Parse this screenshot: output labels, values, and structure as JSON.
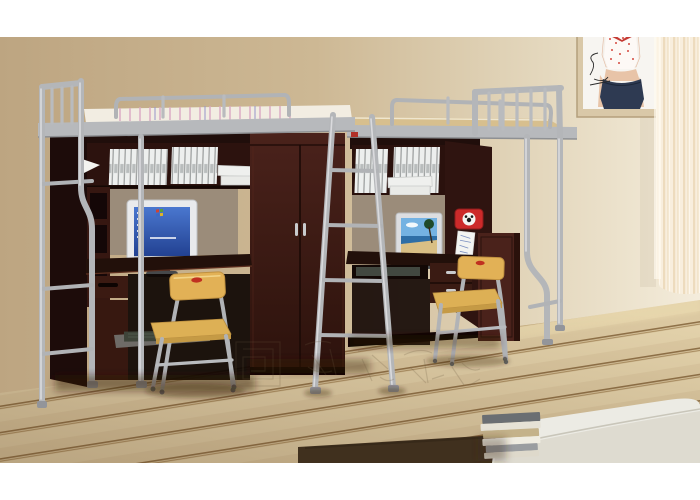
{
  "image": {
    "kind": "furniture product photograph",
    "subject": "two metal loft beds over computer desk and wardrobe units in a dormitory room",
    "visible_text": "none (only an illegible outlined watermark on the floor)"
  },
  "scene": {
    "room": {
      "wall": "beige painted wall, lighter toward the right",
      "floor": "light diagonal wood plank flooring",
      "window": "sheer cream curtain at right edge",
      "poster": "fashion poster of a woman in polka-dot top and jeans on right wall (top cropped)"
    },
    "objects": {
      "left_unit": "silver loft bed; below: shelf with white binders, hutch with CRT monitor showing blue desktop, drawer, keyboard tray, two-door wardrobe",
      "right_unit": "silver loft bed (wood slat top); below: shelf with white binders, monitor showing beach photo, red cartoon clock, pinned paper, drawers, side cabinet",
      "middle_ladder": "silver access ladder leaning between the two units",
      "chairs": "two yellow wooden school chairs with silver tube frames and small red oval badge on backrest",
      "ottoman": "white upholstered bed/ottoman corner, bottom right",
      "books": "stack of books on dark brown rug beside ottoman",
      "watermark": "faint outlined logo plus CJK-style characters across the floor"
    },
    "colors": {
      "wall": "#cdb894",
      "floor_wood": "#dcc9a2",
      "floor_line": "#8f7148",
      "metal": "#b4b6b9",
      "wood_dark": "#33160f",
      "wood_mid": "#4a221b",
      "wood_desk": "#22100a",
      "mattress": "#f2ede2",
      "chair_back": "#e2b156",
      "chair_seat": "#ddb055",
      "binder": "#edefee",
      "screen_blue": "#2c4a9e",
      "clock_red": "#cc2a2a",
      "curtain": "#f3e6cf",
      "ottoman": "#ecebe4",
      "rug": "#40301e",
      "hutch_back": "#9b8c7a"
    }
  }
}
